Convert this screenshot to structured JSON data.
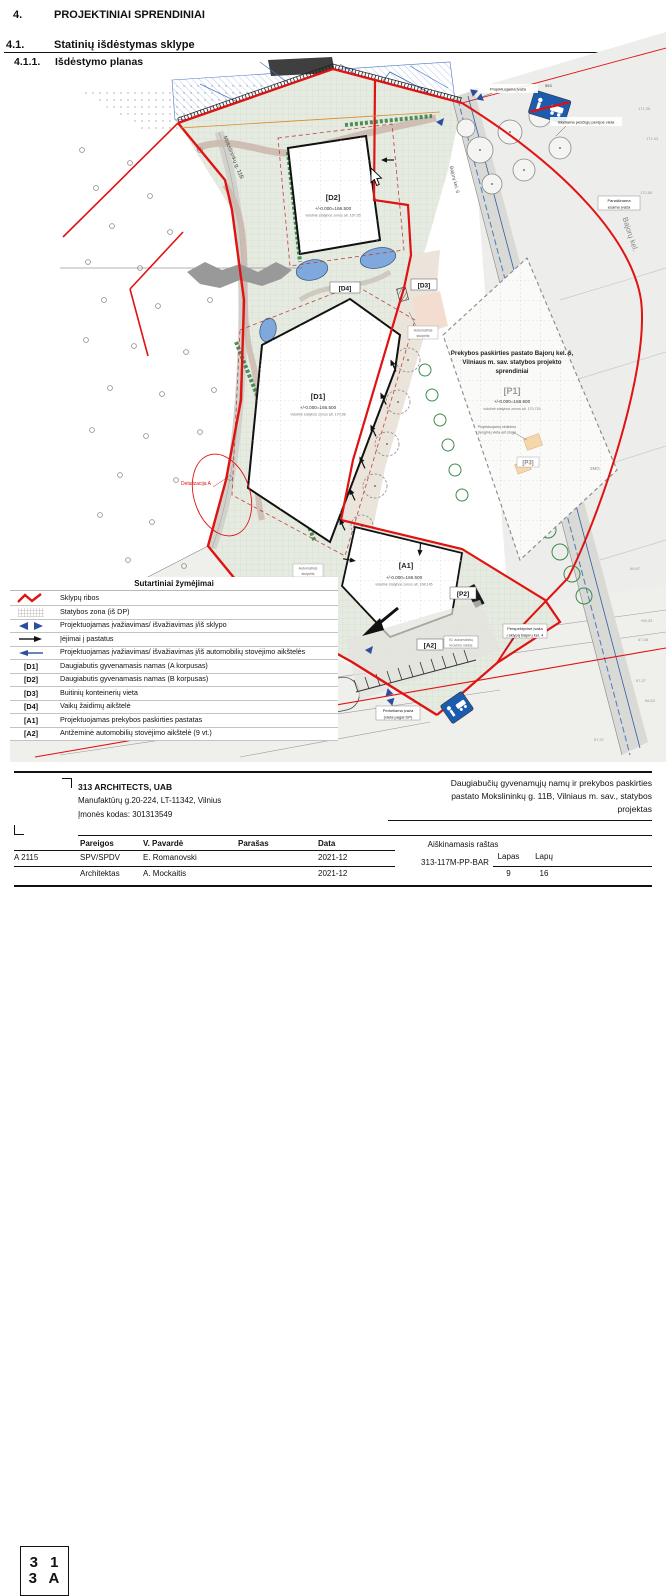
{
  "page": {
    "h1_num": "4.",
    "h1": "PROJEKTINIAI SPRENDINIAI",
    "h2_num": "4.1.",
    "h2": "Statinių išdėstymas sklype",
    "h3_num": "4.1.1.",
    "h3": "Išdėstymo planas"
  },
  "plan": {
    "streets": {
      "mokslininku": "Mokslininkų g. 11B",
      "bajoru": "Bajorų kel.",
      "bajoru6": "Bajorų kel. 6"
    },
    "buildings": {
      "d2": {
        "code": "[D2]",
        "elev": "+/-0.000=166.500",
        "zone": "vidutinė statybos zonos alt. 167,05"
      },
      "d1": {
        "code": "[D1]",
        "elev": "+/-0.000=166.500",
        "zone": "vidutinė statybos zonos alt. 170,98"
      },
      "a1": {
        "code": "[A1]",
        "elev": "+/-0.000=166.500",
        "zone": "vidutinė statybos zonos alt. 168,145"
      },
      "p1": {
        "code": "[P1]",
        "elev": "+/-0.000=166.500",
        "zone": "vidutinė statybos zonos alt. 170,715",
        "title1": "Prekybos paskirties pastato Bajorų kel. 6,",
        "title2": "Vilniaus m. sav. statybos projekto",
        "title3": "sprendiniai",
        "vent1": "Projektuojamų vėdinimo",
        "vent2": "įrenginių vieta ant stogo"
      },
      "d3": "[D3]",
      "d4": "[D4]",
      "a2": "[A2]",
      "p2": "[P2]",
      "p3": "[P3]"
    },
    "annotations": {
      "bollard1": "Automatinis",
      "bollard2": "stulpelis",
      "entry_mok1": "Projektuojama įvaža",
      "entry_mok2": "į sklypą Mokslininkų g. 11",
      "entry_mok3": "(vieta pagal DP)",
      "entry_moved1": "Perkeliama įvaža",
      "entry_moved2": "(vieta pagal DP)",
      "entry_persp1": "Perspektyvinė įvaža",
      "entry_persp2": "į sklypą Bajorų kel. 4",
      "entry_top": "Projektuojama įvaža",
      "crossing": "Iškeliama pėsčiųjų perėjos vieta",
      "removed1": "Panaikinama",
      "removed2": "esama įvaža",
      "ev1": "El. automobilių",
      "ev2": "krovimo vietos",
      "detail": "Detalizacija A"
    },
    "spots": {
      "s1": "171,06",
      "s2": "171,03",
      "s3": "170,65",
      "s4": "+69,33",
      "s5": "67,38",
      "s6": "69,87",
      "s7": "67,27",
      "s8": "66,53",
      "s9": "67,37",
      "s10": "553",
      "s11": "2MG",
      "s12": "A"
    }
  },
  "legend": {
    "title": "Sutartiniai žymėjimai",
    "items": [
      {
        "type": "zigzag",
        "label": "Sklypų ribos"
      },
      {
        "type": "grid",
        "label": "Statybos zona (iš DP)"
      },
      {
        "type": "double-arrow",
        "label": "Projektuojamas įvažiavimas/ išvažiavimas į/iš sklypo"
      },
      {
        "type": "entry-arrow",
        "label": "Įėjimai į pastatus"
      },
      {
        "type": "single-arrow",
        "label": "Projektuojamas įvažiavimas/ išvažiavimas į/iš automobilių stovėjimo aikštelės"
      },
      {
        "code": "[D1]",
        "label": "Daugiabutis gyvenamasis namas (A korpusas)"
      },
      {
        "code": "[D2]",
        "label": "Daugiabutis gyvenamasis namas (B korpusas)"
      },
      {
        "code": "[D3]",
        "label": "Buitinių konteinerių vieta"
      },
      {
        "code": "[D4]",
        "label": "Vaikų žaidimų aikštelė"
      },
      {
        "code": "[A1]",
        "label": "Projektuojamas prekybos paskirties pastatas"
      },
      {
        "code": "[A2]",
        "label": "Antžeminė automobilių stovėjimo aikštelė (9 vt.)"
      }
    ]
  },
  "titleblock": {
    "logo_line1": "3 1",
    "logo_line2": "3 A",
    "company_name": "313 ARCHITECTS, UAB",
    "company_address": "Manufaktūrų g.20-224, LT-11342, Vilnius",
    "company_code": "Įmonės kodas: 301313549",
    "project_line1": "Daugiabučių gyvenamųjų namų ir prekybos paskirties",
    "project_line2": "pastato Mokslininkų g. 11B, Vilniaus m. sav., statybos",
    "project_line3": "projektas",
    "cert": "A 2115",
    "col_pareigos": "Pareigos",
    "col_pavarde": "V. Pavardė",
    "col_parasas": "Parašas",
    "col_data": "Data",
    "row1_pareigos": "SPV/SPDV",
    "row1_pavarde": "E. Romanovski",
    "row1_data": "2021-12",
    "row2_pareigos": "Architektas",
    "row2_pavarde": "A. Mockaitis",
    "row2_data": "2021-12",
    "doc_type": "Aiškinamasis raštas",
    "doc_code": "313-117M-PP-BAR",
    "lapas_label": "Lapas",
    "lapas": "9",
    "lapu_label": "Lapų",
    "lapu": "16"
  },
  "colors": {
    "boundary_red": "#e01212",
    "sign_blue": "#1c5cae",
    "water_blue": "#6f9bd2",
    "site_green": "#e6ebe1"
  }
}
